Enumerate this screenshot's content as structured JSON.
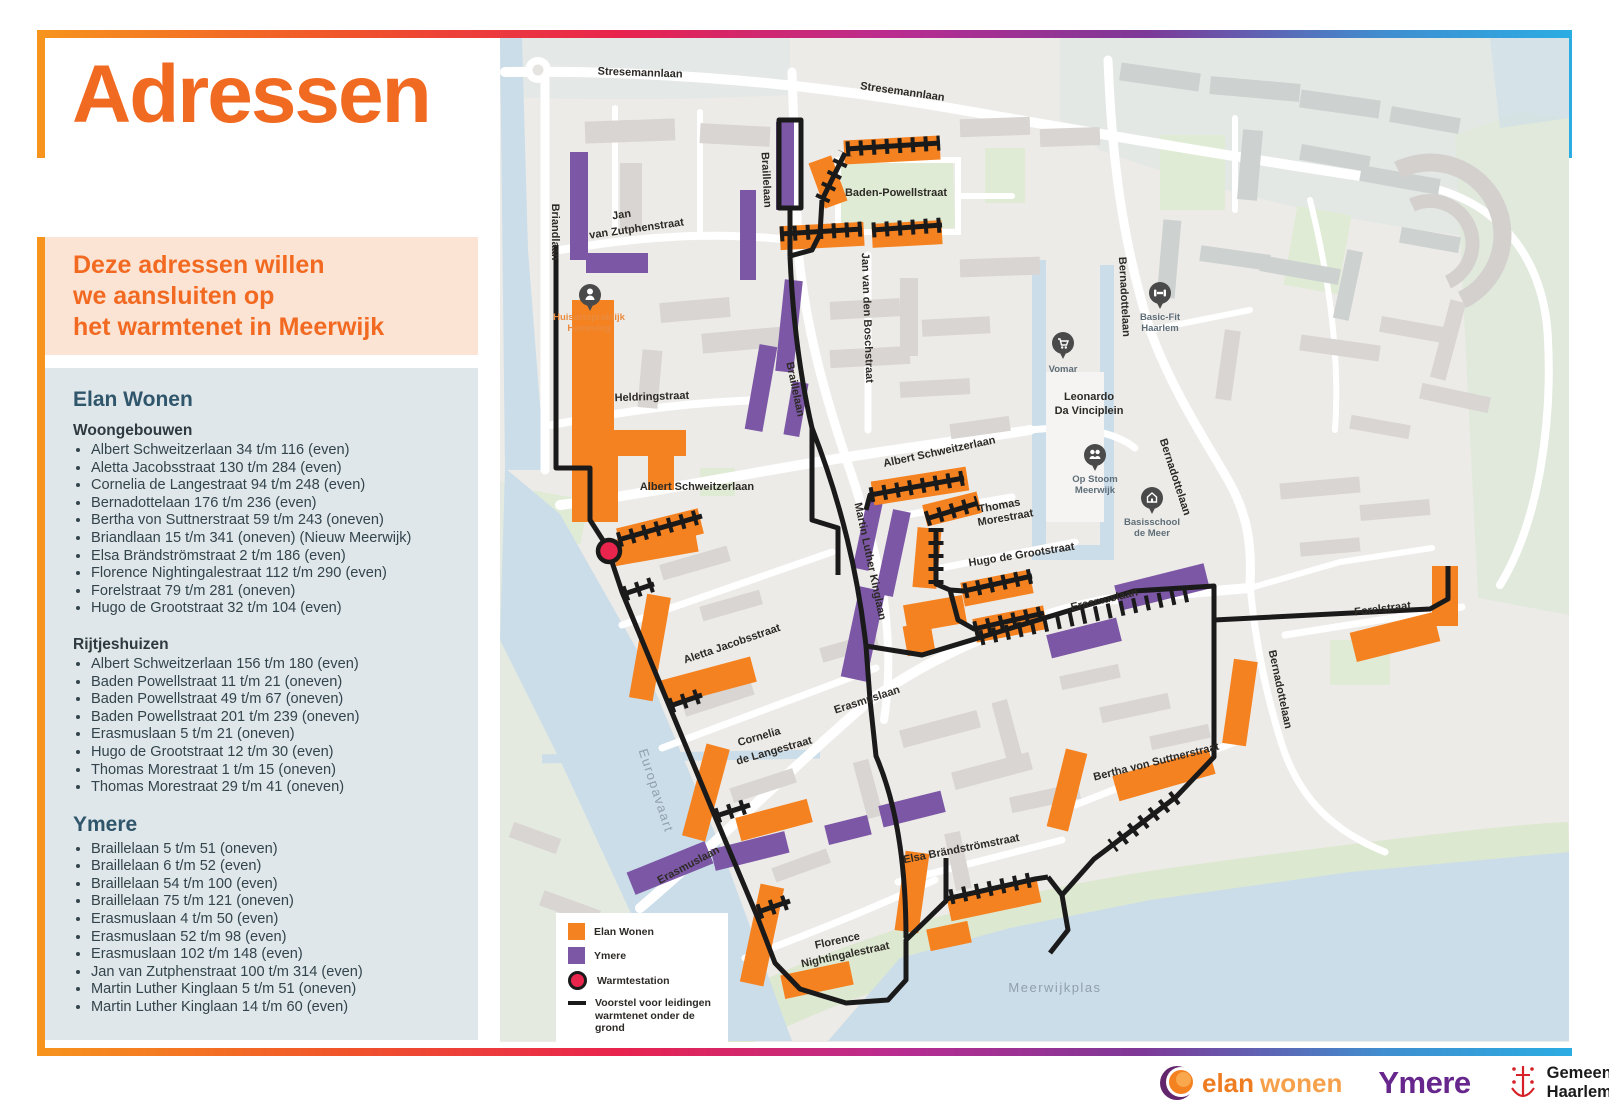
{
  "header": {
    "title": "Adressen"
  },
  "logo": {
    "warmtenet_letters": [
      [
        "W",
        "#F7941E"
      ],
      [
        "a",
        "#F6831E"
      ],
      [
        "r",
        "#F3701F"
      ],
      [
        "m",
        "#EF5A24"
      ],
      [
        "t",
        "#EA2D2E"
      ],
      [
        "e",
        "#E01E50"
      ],
      [
        "n",
        "#A82C8F"
      ],
      [
        "e",
        "#7F3294"
      ],
      [
        "t",
        "#4E55A5"
      ]
    ],
    "meerwijk": "Meerwijk"
  },
  "intro": {
    "lines": [
      "Deze adressen willen",
      "we aansluiten op",
      "het warmtenet in Meerwijk"
    ]
  },
  "list": {
    "elan_heading": "Elan Wonen",
    "woongebouwen_label": "Woongebouwen",
    "woongebouwen": [
      "Albert Schweitzerlaan 34 t/m 116 (even)",
      "Aletta Jacobsstraat 130 t/m 284 (even)",
      "Cornelia de Langestraat 94 t/m 248 (even)",
      "Bernadottelaan 176 t/m 236 (even)",
      "Bertha von Suttnerstraat 59 t/m 243 (oneven)",
      "Briandlaan 15 t/m 341 (oneven) (Nieuw Meerwijk)",
      "Elsa Brändströmstraat 2 t/m 186 (even)",
      "Florence Nightingalestraat 112 t/m 290 (even)",
      "Forelstraat 79 t/m 281 (oneven)",
      "Hugo de Grootstraat 32 t/m 104 (even)"
    ],
    "rijtjeshuizen_label": "Rijtjeshuizen",
    "rijtjeshuizen": [
      "Albert Schweitzerlaan 156 t/m 180 (even)",
      "Baden Powellstraat 11 t/m 21 (oneven)",
      "Baden Powellstraat 49 t/m 67 (oneven)",
      "Baden Powellstraat 201 t/m 239 (oneven)",
      "Erasmuslaan 5 t/m 21 (oneven)",
      "Hugo de Grootstraat 12 t/m 30 (even)",
      "Thomas Morestraat 1 t/m 15 (oneven)",
      "Thomas Morestraat 29 t/m 41 (oneven)"
    ],
    "ymere_heading": "Ymere",
    "ymere": [
      "Braillelaan 5 t/m 51 (oneven)",
      "Braillelaan 6 t/m 52 (even)",
      "Braillelaan 54 t/m 100 (even)",
      "Braillelaan 75 t/m 121 (oneven)",
      "Erasmuslaan 4 t/m 50 (even)",
      "Erasmuslaan 52 t/m 98 (even)",
      "Erasmuslaan 102 t/m 148 (even)",
      "Jan van Zutphenstraat 100 t/m 314 (even)",
      "Martin Luther Kinglaan 5 t/m 51 (oneven)",
      "Martin Luther Kinglaan 14 t/m 60 (even)"
    ]
  },
  "legend": {
    "elan": "Elan Wonen",
    "ymere": "Ymere",
    "warmtestation": "Warmtestation",
    "leiding": [
      "Voorstel voor leidingen",
      "warmtenet onder de grond"
    ]
  },
  "map": {
    "labels": {
      "stresemannlaan1": "Stresemannlaan",
      "stresemannlaan2": "Stresemannlaan",
      "briandlaan": "Briandlaan",
      "jvz": [
        "Jan",
        "van Zutphenstraat"
      ],
      "braillelaan1": "Braillelaan",
      "braillelaan2": "Braillelaan",
      "badenpowellstraat": "Baden-Powellstraat",
      "jvdboschstraat": "Jan van den Boschstraat",
      "heldringstraat": "Heldringstraat",
      "albertschweitzerlaan1": "Albert Schweitzerlaan",
      "albertschweitzerlaan2": "Albert Schweitzerlaan",
      "thomas": [
        "Thomas",
        "Morestraat"
      ],
      "hugodegrootstraat": "Hugo de Grootstraat",
      "mlklaan": "Martin Luther Kinglaan",
      "erasmuslaan1": "Erasmuslaan",
      "erasmuslaan2": "Erasmuslaan",
      "erasmuslaan3": "Erasmuslaan",
      "alettajacobsstraat": "Aletta Jacobsstraat",
      "cornelia": [
        "Cornelia",
        "de Langestraat"
      ],
      "florence": [
        "Florence",
        "Nightingalestraat"
      ],
      "elsabrandstromstraat": "Elsa Brändströmstraat",
      "berthavonsuttnerstraat": "Bertha von Suttnerstraat",
      "bernadottelaan1": "Bernadottelaan",
      "bernadottelaan2": "Bernadottelaan",
      "bernadottelaan3": "Bernadottelaan",
      "forelstraat": "Forelstraat",
      "leonardo": [
        "Leonardo",
        "Da Vinciplein"
      ],
      "europavaart": "Europavaart",
      "meerwijkplas": "Meerwijkplas"
    },
    "pois": {
      "huisarts": [
        "Huisartspraktijk",
        "Hamming"
      ],
      "vomar": "Vomar",
      "basicfit": [
        "Basic-Fit",
        "Haarlem"
      ],
      "opstoom": [
        "Op Stoom",
        "Meerwijk"
      ],
      "basisschool": [
        "Basisschool",
        "de Meer"
      ]
    }
  },
  "footer": {
    "elan_word1": "elan",
    "elan_word2": "wonen",
    "ymere": "Ymere",
    "gemeente": [
      "Gemeente",
      "Haarlem"
    ]
  },
  "colors": {
    "elan_orange": "#F58220",
    "ymere_purple": "#7B57A5",
    "warmtestation_red": "#E9254E",
    "pipe_black": "#1A1A1A",
    "accent_orange": "#F7941D",
    "water": "#CBDDE9",
    "green": "#DFEBD5",
    "building_gray": "#D9D5D2",
    "map_bg": "#EDEBE8"
  }
}
